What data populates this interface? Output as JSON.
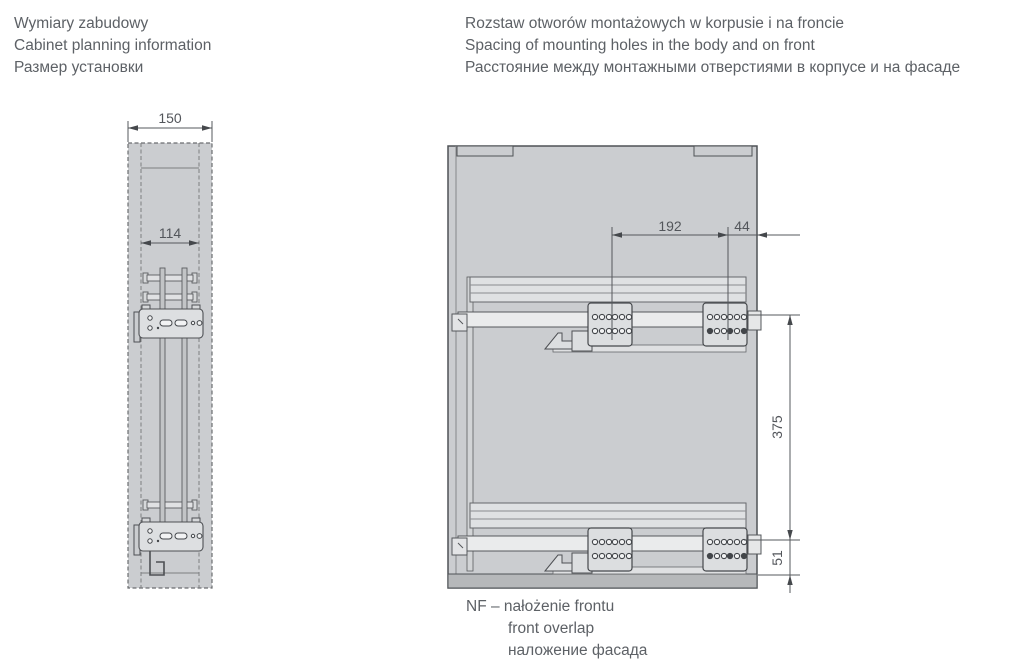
{
  "header_left": {
    "lines": [
      "Wymiary zabudowy",
      "Cabinet planning information",
      "Размер установки"
    ]
  },
  "header_right": {
    "lines": [
      "Rozstaw otworów montażowych w korpusie i na froncie",
      "Spacing of mounting holes in the body and on front",
      "Расстояние между монтажными отверстиями в корпусе и на фасаде"
    ]
  },
  "footnote": {
    "lines": [
      "NF – nałożenie frontu",
      "front overlap",
      "наложение фасада"
    ]
  },
  "front_view": {
    "dimensions": {
      "outer_width": "150",
      "inner_width": "114"
    }
  },
  "side_view": {
    "dimensions": {
      "hole_spacing_depth": "192",
      "front_offset": "44",
      "hole_spacing_vertical": "375",
      "bottom_offset": "51"
    }
  },
  "colors": {
    "text": "#5d6166",
    "dimension_text": "#53565b",
    "line": "#4f5256",
    "cabinet_fill": "#cbcdd0",
    "panel_light": "#eaebec",
    "bottom_panel": "#b6b8ba"
  }
}
